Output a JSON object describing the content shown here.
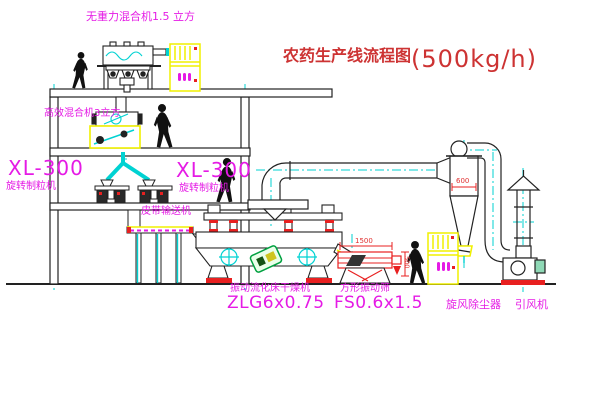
{
  "title": {
    "text": "农药生产线流程图",
    "capacity": "(500kg/h)"
  },
  "equipment_labels": {
    "mixer_top": "无重力混合机1.5 立方",
    "mixer_second": "高效混合机3立方",
    "granulator_left_model": "XL-300",
    "granulator_left_name": "旋转制粒机",
    "granulator_mid_model": "XL-300",
    "granulator_mid_name": "旋转制粒机",
    "belt_conveyor": "皮带输送机",
    "dryer_name": "振动流化床干燥机",
    "dryer_model": "ZLG6x0.75",
    "sieve_name": "方形振动筛",
    "sieve_model": "FS0.6x1.5",
    "cyclone": "旋风除尘器",
    "fan": "引风机"
  },
  "dimensions": {
    "sieve_length": "1500",
    "cyclone_inlet": "600",
    "sieve_height": "500"
  },
  "colors": {
    "label_magenta": "#e51ae5",
    "title_red": "#cd3333",
    "line_black": "#222222",
    "accent_cyan": "#00d2d2",
    "accent_yellow": "#f0f000",
    "accent_red": "#e82020",
    "stamp_green": "#00a040"
  }
}
